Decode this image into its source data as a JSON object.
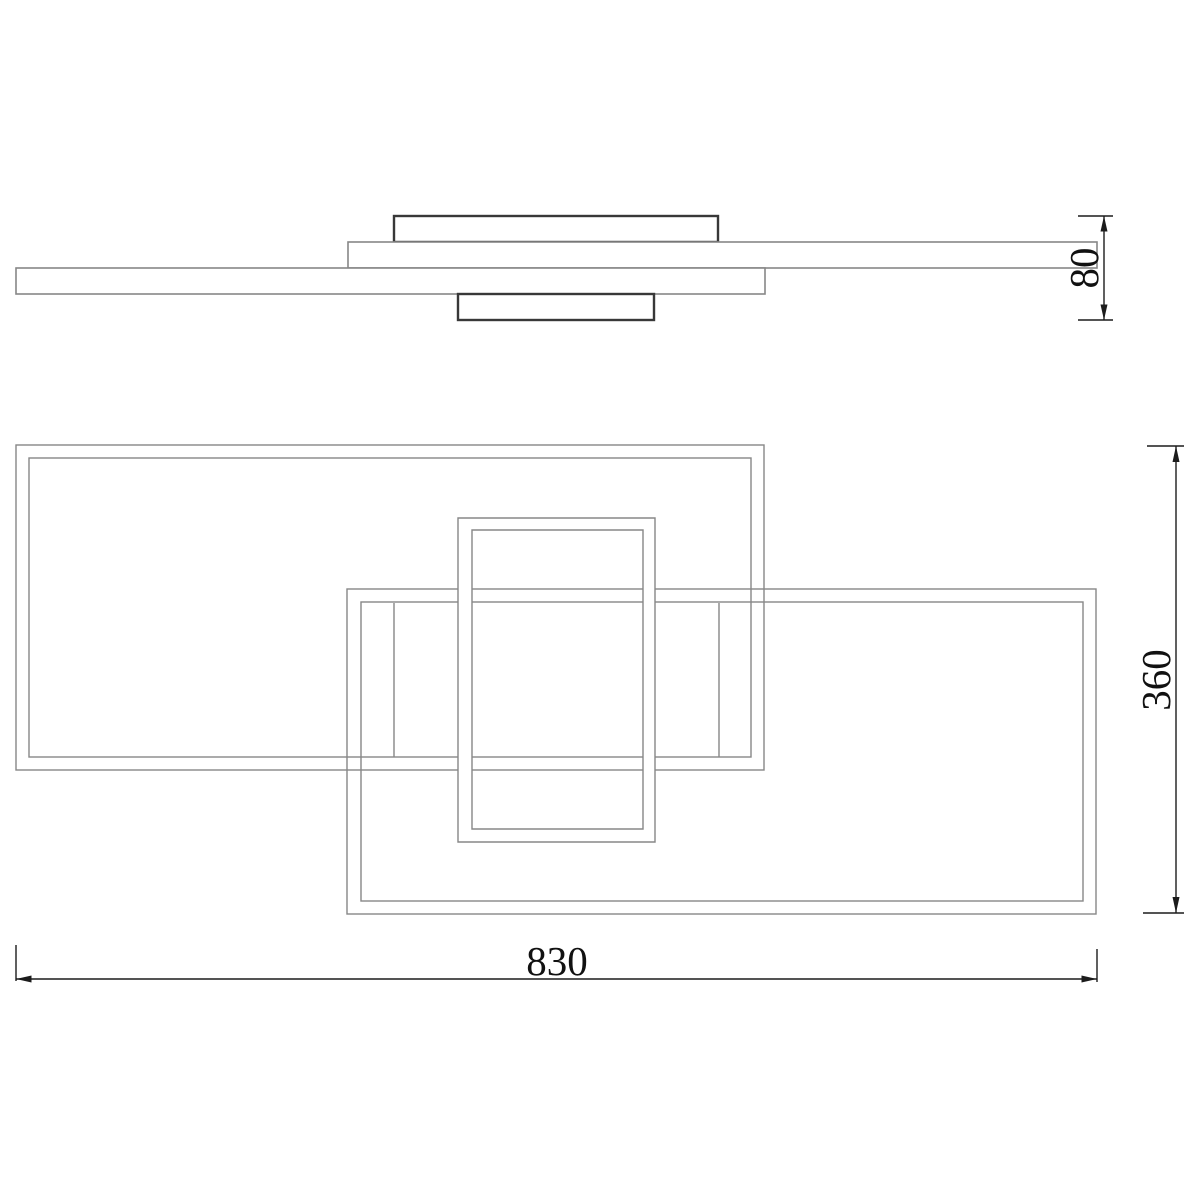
{
  "drawing": {
    "kind": "technical-drawing",
    "views": {
      "front": "front-profile-view",
      "top": "top-plan-view"
    }
  },
  "dimensions": {
    "height": {
      "value": "80",
      "orientation": "vertical-right-of-front-view"
    },
    "depth": {
      "value": "360",
      "orientation": "vertical-right-of-top-view"
    },
    "width": {
      "value": "830",
      "orientation": "horizontal-below-top-view"
    }
  },
  "colors": {
    "background": "#ffffff",
    "line-gray": "#878787",
    "line-dark": "#383838",
    "dim-black": "#1c1c1c"
  }
}
